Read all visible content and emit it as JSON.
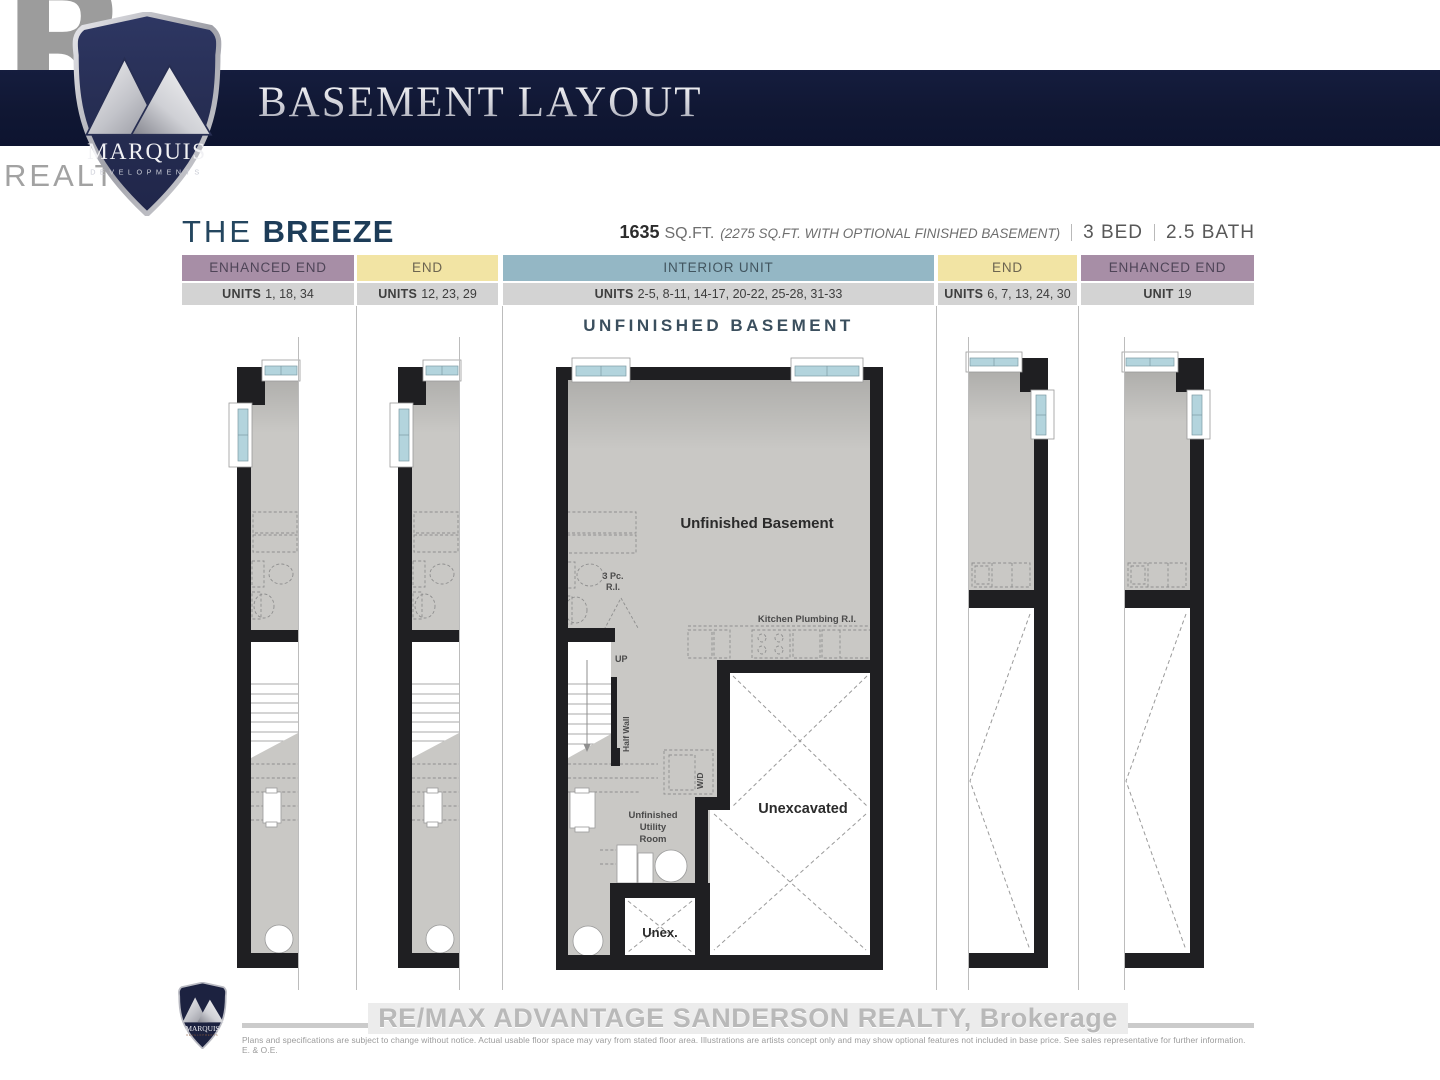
{
  "header": {
    "banner_title": "BASEMENT LAYOUT",
    "realtor_letter": "R",
    "realtor_word": "REALTOR",
    "realtor_reg": "®",
    "logo_name": "MARQUIS",
    "logo_sub": "DEVELOPMENTS"
  },
  "plan": {
    "name_prefix": "THE",
    "name": "BREEZE",
    "sqft": "1635",
    "sqft_unit": "SQ.FT.",
    "sqft_note": "(2275 SQ.FT. WITH OPTIONAL FINISHED BASEMENT)",
    "beds": "3 BED",
    "baths": "2.5 BATH"
  },
  "table": {
    "columns": [
      {
        "type": "ENHANCED END",
        "units_label": "UNITS",
        "units": "1, 18, 34",
        "color": "#a78ea6"
      },
      {
        "type": "END",
        "units_label": "UNITS",
        "units": "12, 23, 29",
        "color": "#f2e4a4"
      },
      {
        "type": "INTERIOR UNIT",
        "units_label": "UNITS",
        "units": "2-5, 8-11, 14-17, 20-22, 25-28, 31-33",
        "color": "#94b7c5"
      },
      {
        "type": "END",
        "units_label": "UNITS",
        "units": "6, 7, 13, 24, 30",
        "color": "#f2e4a4"
      },
      {
        "type": "ENHANCED END",
        "units_label": "UNIT",
        "units": "19",
        "color": "#a78ea6"
      }
    ]
  },
  "section_title": "UNFINISHED BASEMENT",
  "floorplan_labels": {
    "room": "Unfinished Basement",
    "bath_ri_1": "3 Pc.",
    "bath_ri_2": "R.I.",
    "kitchen_ri": "Kitchen Plumbing R.I.",
    "up": "UP",
    "half_wall": "Half Wall",
    "wd": "W/D",
    "utility_1": "Unfinished",
    "utility_2": "Utility",
    "utility_3": "Room",
    "unexcavated": "Unexcavated",
    "unex_small": "Unex."
  },
  "footer": {
    "brokerage": "RE/MAX ADVANTAGE SANDERSON REALTY, Brokerage",
    "disclaimer": "Plans and specifications are subject to change without notice.  Actual usable floor space may vary from stated floor area.  Illustrations are artists concept only and may show optional features not included in base price.  See sales representative for further information. E. & O.E."
  },
  "colors": {
    "banner_navy": "#101733",
    "shield_navy": "#272e52",
    "title_navy": "#1d3c58",
    "enhanced_end": "#a78ea6",
    "end": "#f2e4a4",
    "interior_unit": "#94b7c5",
    "units_row_gray": "#d3d3d3",
    "plan_wall": "#1f1f22",
    "plan_floor_gray": "#c9c8c5",
    "window_glass_blue": "#b3d4dd"
  }
}
